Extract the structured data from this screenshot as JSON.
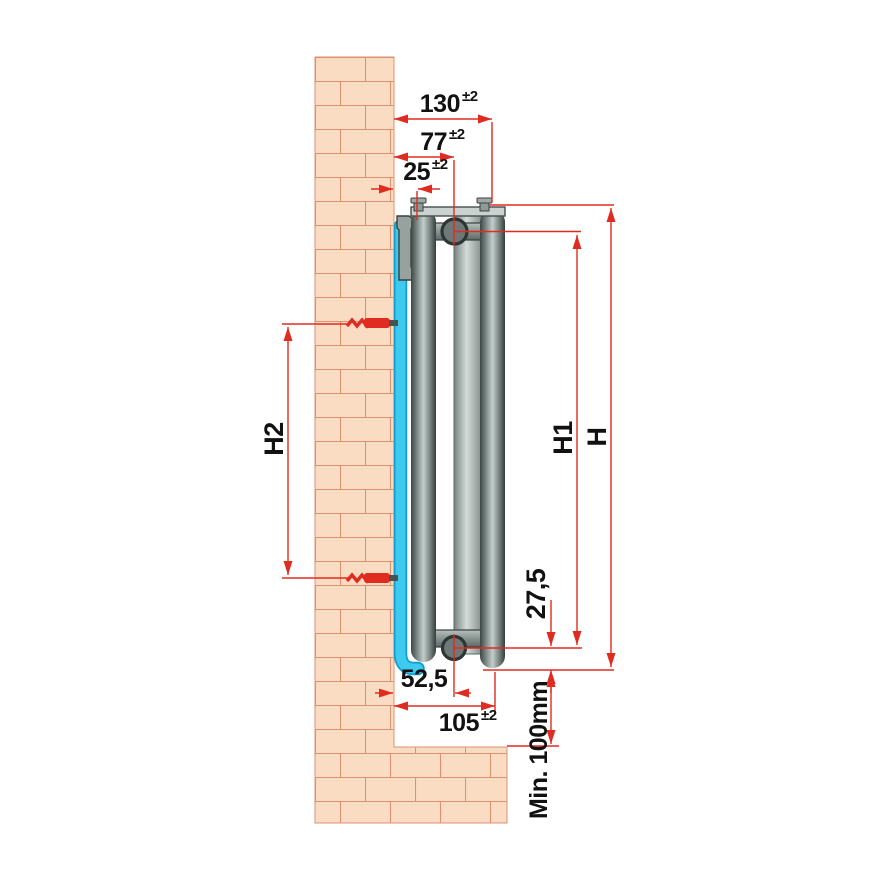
{
  "diagram": {
    "kind": "panel-radiator wall-mounting side-view installation drawing",
    "labels": {
      "d130": {
        "value": "130",
        "tol": "±2"
      },
      "d77": {
        "value": "77",
        "tol": "±2"
      },
      "d25": {
        "value": "25",
        "tol": "±2"
      },
      "d105": {
        "value": "105",
        "tol": "±2"
      },
      "d52_5": {
        "value": "52,5"
      },
      "d27_5": {
        "value": "27,5"
      },
      "h": {
        "value": "H"
      },
      "h1": {
        "value": "H1"
      },
      "h2": {
        "value": "H2"
      },
      "min_floor_clearance": {
        "value": "Min. 100mm"
      }
    },
    "colors": {
      "dimension_red": "#e02b20",
      "text": "#111111",
      "brick_fill": "#fadcc2",
      "brick_joint": "#dc9170",
      "pipe_cyan": "#3ec9f0",
      "pipe_cyan_border": "#0e9fce",
      "metal_dark": "#414c49",
      "metal_mid": "#8e9a97",
      "metal_light": "#c3cecb",
      "background": "#ffffff"
    }
  }
}
